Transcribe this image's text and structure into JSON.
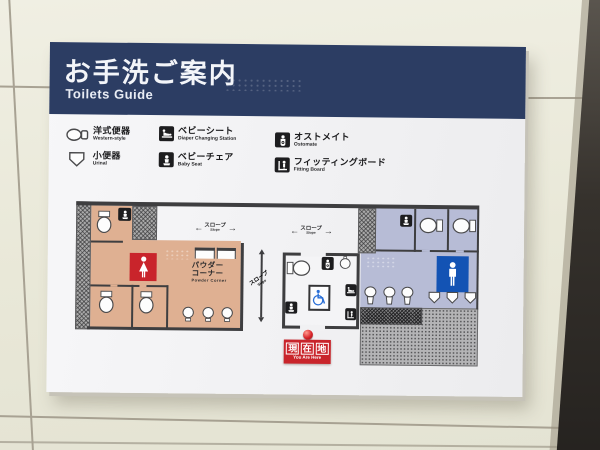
{
  "sign": {
    "title_jp": "お手洗ご案内",
    "title_en": "Toilets Guide",
    "legend": {
      "items": [
        {
          "jp": "洋式便器",
          "en": "Western-style",
          "icon": "western-toilet-outline-icon"
        },
        {
          "jp": "小便器",
          "en": "Urinal",
          "icon": "urinal-outline-icon"
        },
        {
          "jp": "ベビーシート",
          "en": "Diaper Changing Station",
          "icon": "diaper-changing-icon"
        },
        {
          "jp": "ベビーチェア",
          "en": "Baby Seat",
          "icon": "baby-seat-icon"
        },
        {
          "jp": "オストメイト",
          "en": "Ostomate",
          "icon": "ostomate-icon"
        },
        {
          "jp": "フィッティングボード",
          "en": "Fitting Board",
          "icon": "fitting-board-icon"
        }
      ]
    },
    "map": {
      "slopes": [
        {
          "jp": "スロープ",
          "en": "Slope",
          "arrow_left": "←",
          "arrow_right": "→",
          "orientation": "horizontal"
        },
        {
          "jp": "スロープ",
          "en": "Slope",
          "arrow_left": "←",
          "arrow_right": "→",
          "orientation": "horizontal"
        },
        {
          "jp": "スロープ",
          "en": "Slope",
          "orientation": "vertical"
        }
      ],
      "powder_corner": {
        "jp_line1": "パウダー",
        "jp_line2": "コーナー",
        "en": "Powder Corner"
      },
      "you_are_here": {
        "chars": [
          "現",
          "在",
          "地"
        ],
        "en": "You Are Here"
      }
    },
    "colors": {
      "header_navy": "#2c3d63",
      "womens_tan": "#dfb092",
      "mens_blue": "#b7bcd6",
      "accent_red": "#c9242b",
      "mens_icon_blue": "#1353b4",
      "wheelchair_blue": "#2a6fd6",
      "map_wall": "#3e3e40",
      "sign_white": "#f3f3f5",
      "tile_beige": "#eae9da"
    }
  }
}
